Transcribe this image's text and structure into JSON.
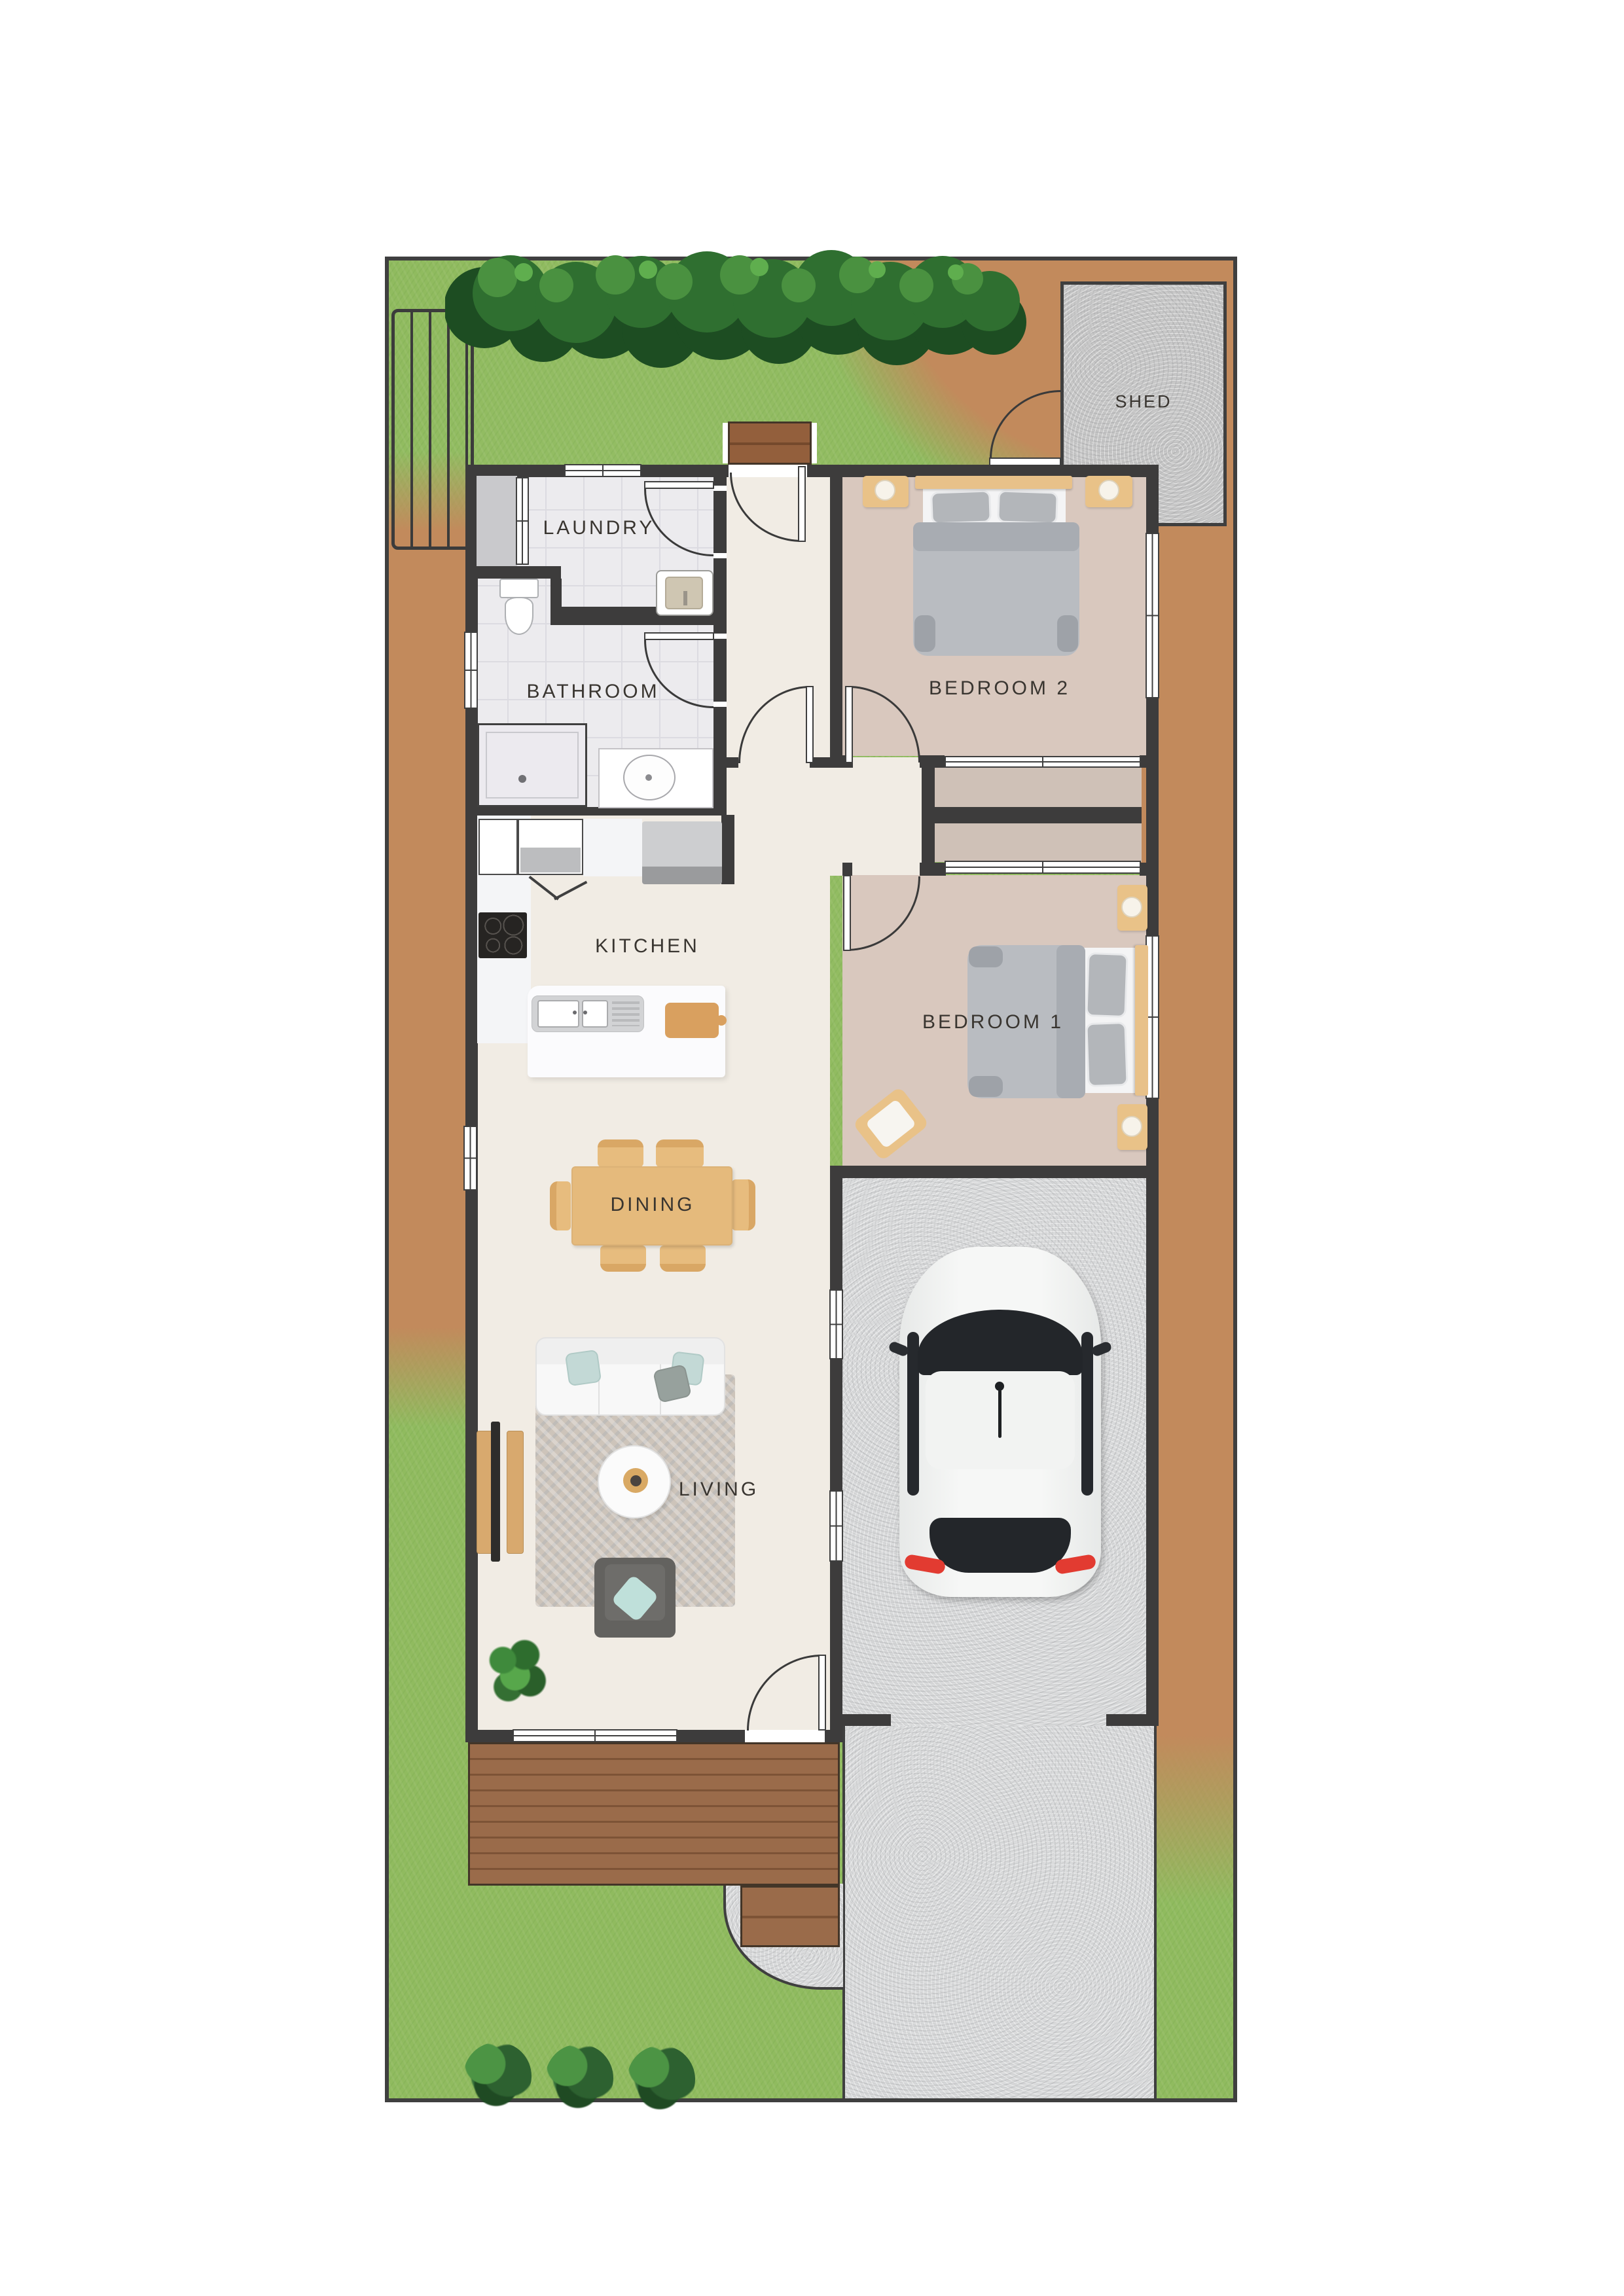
{
  "floor_plan": {
    "labels": {
      "shed": "SHED",
      "laundry": "LAUNDRY",
      "bathroom": "BATHROOM",
      "kitchen": "KITCHEN",
      "dining": "DINING",
      "living": "LIVING",
      "bedroom1": "BEDROOM 1",
      "bedroom2": "BEDROOM 2"
    },
    "rooms": [
      {
        "name": "Laundry"
      },
      {
        "name": "Bathroom"
      },
      {
        "name": "Kitchen"
      },
      {
        "name": "Dining"
      },
      {
        "name": "Living"
      },
      {
        "name": "Bedroom 1"
      },
      {
        "name": "Bedroom 2"
      },
      {
        "name": "Shed"
      },
      {
        "name": "Carport"
      }
    ],
    "colors": {
      "grass": "#90bb5f",
      "dirt": "#c28a5c",
      "wall": "#3d3c3c",
      "tile_floor": "#ecebee",
      "internal_floor": "#f1ece4",
      "bedroom_floor": "#d9c8be",
      "concrete": "#dadbdc",
      "deck_timber": "#9a6b4a",
      "furniture_timber": "#e5ba7c",
      "label_text": "#393530"
    }
  }
}
